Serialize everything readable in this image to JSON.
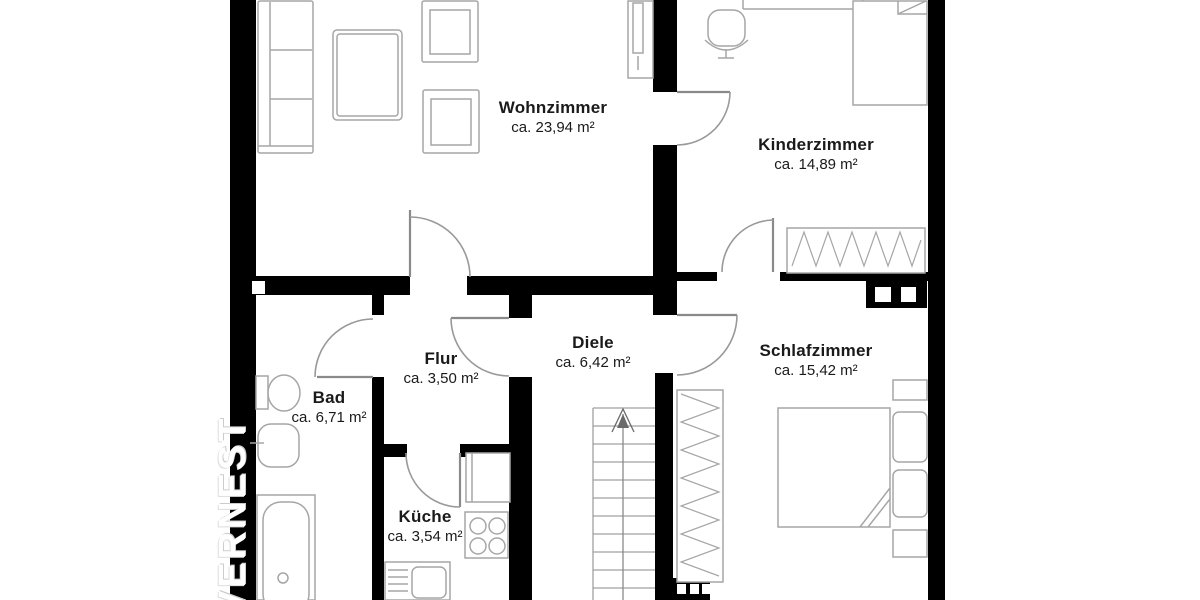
{
  "watermark": {
    "text": "VERNEST"
  },
  "rooms": [
    {
      "name": "Wohnzimmer",
      "area": "ca. 23,94 m²"
    },
    {
      "name": "Kinderzimmer",
      "area": "ca. 14,89 m²"
    },
    {
      "name": "Flur",
      "area": "ca. 3,50 m²"
    },
    {
      "name": "Diele",
      "area": "ca. 6,42 m²"
    },
    {
      "name": "Schlafzimmer",
      "area": "ca. 15,42 m²"
    },
    {
      "name": "Bad",
      "area": "ca. 6,71 m²"
    },
    {
      "name": "Küche",
      "area": "ca. 3,54 m²"
    }
  ],
  "colors": {
    "wall": "#000000",
    "background": "#ffffff",
    "furniture_outline": "#a6a6a6",
    "door_arc": "#999999",
    "label_text": "#1a1a1a",
    "watermark_text": "#ffffff"
  },
  "icons": [
    "sofa",
    "coffee-table",
    "armchair",
    "shelf-cabinet",
    "floor-lamp",
    "desk",
    "desk-chair",
    "single-bed",
    "wardrobe",
    "double-bed",
    "nightstand",
    "pillow",
    "stairs",
    "stairs-up-arrow",
    "toilet",
    "washbasin",
    "bathtub",
    "kitchen-counter",
    "stove",
    "kitchen-sink",
    "chimney-shaft",
    "ventilation-shaft"
  ]
}
